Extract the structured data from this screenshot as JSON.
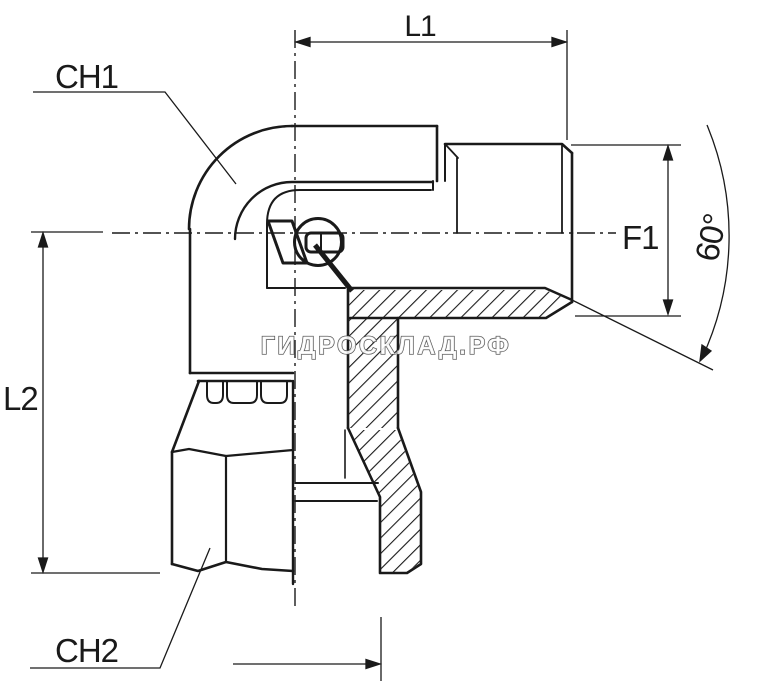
{
  "drawing": {
    "description": "Technical drawing of a 90 degree hydraulic elbow adapter fitting, side view with half-section, male threaded stud end on the right and swivel nut port on the bottom",
    "background_color": "#ffffff",
    "line_color": "#1a1a1a",
    "labels": {
      "ch1": "CH1",
      "l1": "L1",
      "f1": "F1",
      "angle": "60°",
      "l2": "L2",
      "ch2": "CH2"
    },
    "watermark": {
      "text": "ГИДРОСКЛАД.РФ",
      "fill_color": "#ffffff",
      "outline_color": "#4c4c4c"
    }
  }
}
